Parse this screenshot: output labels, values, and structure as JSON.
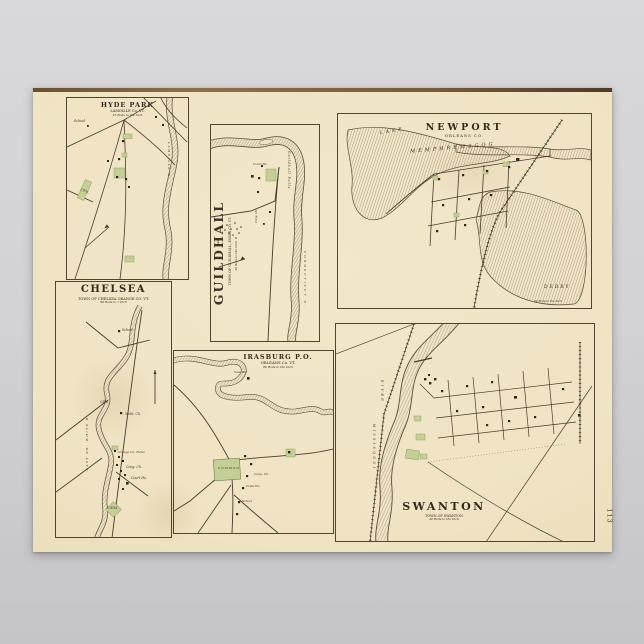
{
  "scene": {
    "background_top": "#d9d9db",
    "background_bottom": "#c5c5c8"
  },
  "poster": {
    "paper_color": "#f1e6c8",
    "edge_strip_color": "#6b4f35",
    "ink_color": "#42372a",
    "green_color": "#c6ce97",
    "water_hatch_color": "#75634a",
    "page_number": "113"
  },
  "maps": {
    "hyde_park": {
      "title": "HYDE PARK",
      "subtitle": "LAMOILLE Co. VT.",
      "scale_note": "25 Rods to the Inch",
      "labels": {
        "school": "School",
        "cemetery": "CEM.",
        "river": "LAMOILLE R."
      }
    },
    "chelsea": {
      "title": "CHELSEA",
      "subtitle": "TOWN OF CHELSEA ORANGE CO. VT.",
      "scale_note": "60 Rods to 1 Inch",
      "labels": {
        "school": "School",
        "cemetery_upper": "CEM.",
        "methodist_church": "Meth. Ch.",
        "hotel": "Orange Co. Hotel",
        "congregational_church": "Cong. Ch.",
        "court_house": "Court Ho.",
        "cemetery_lower": "CEM.",
        "river": "EAST BR. WHITE R."
      }
    },
    "guildhall": {
      "title": "GUILDHALL",
      "subtitle": "TOWN OF GUILDHALL, ESSEX CO. VT.",
      "scale_note": "40 Rods to the Inch",
      "labels": {
        "falls": "Guildhall Falls",
        "court_house": "Court Ho.",
        "congregational_church": "Cong. Ch.",
        "river": "CONNECTICUT R."
      }
    },
    "newport": {
      "title": "NEWPORT",
      "subtitle": "ORLEANS CO.",
      "scale_note": "50 Rods to the Inch",
      "labels": {
        "lake_word1": "LAKE",
        "lake_word2": "MEMPHREMAGOG",
        "derby": "DERBY"
      }
    },
    "irasburg": {
      "title": "IRASBURG P.O.",
      "subtitle": "ORLEANS Co. VT.",
      "scale_note": "80 Rods to the Inch",
      "labels": {
        "saw_mill": "Saw Mill",
        "common": "COMMON",
        "congregational_church": "Cong. Ch.",
        "town_house": "Town Ho.",
        "school": "School"
      }
    },
    "swanton": {
      "title": "SWANTON",
      "subtitle": "TOWN OF SWANTON",
      "scale_note": "40 Rods to the Inch",
      "labels": {
        "river_word1": "RIVER",
        "river_word2": "MISSISQUOI"
      }
    }
  }
}
